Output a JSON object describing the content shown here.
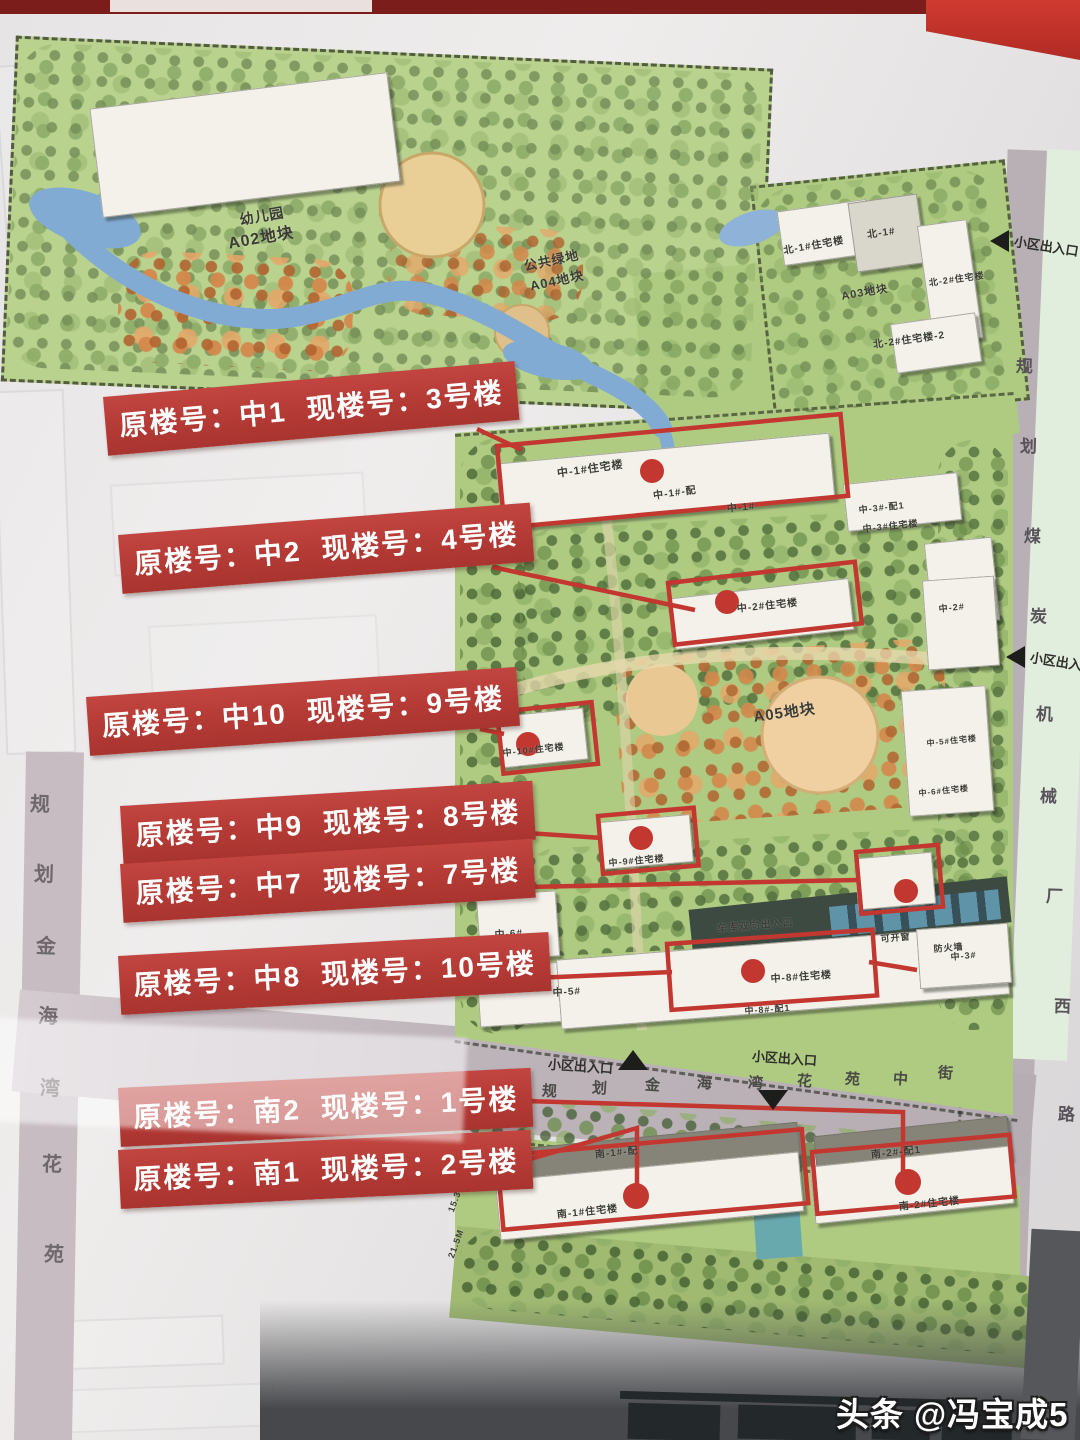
{
  "banners": {
    "label_old": "原楼号：",
    "label_new": "现楼号：",
    "items": [
      {
        "old": "中1",
        "new": "3号楼",
        "x": 103,
        "y": 397,
        "rot": -5.0
      },
      {
        "old": "中2",
        "new": "4号楼",
        "x": 118,
        "y": 535,
        "rot": -4.5
      },
      {
        "old": "中10",
        "new": "9号楼",
        "x": 86,
        "y": 697,
        "rot": -4.0
      },
      {
        "old": "中9",
        "new": "8号楼",
        "x": 120,
        "y": 806,
        "rot": -3.5
      },
      {
        "old": "中7",
        "new": "7号楼",
        "x": 120,
        "y": 864,
        "rot": -3.5
      },
      {
        "old": "中8",
        "new": "10号楼",
        "x": 118,
        "y": 956,
        "rot": -3.2
      },
      {
        "old": "南2",
        "new": "1号楼",
        "x": 118,
        "y": 1088,
        "rot": -2.8
      },
      {
        "old": "南1",
        "new": "2号楼",
        "x": 118,
        "y": 1150,
        "rot": -2.8
      }
    ]
  },
  "roads": {
    "west": {
      "name": "规划金海湾花苑",
      "chars": [
        {
          "c": "规",
          "x": 30,
          "y": 788
        },
        {
          "c": "划",
          "x": 34,
          "y": 858
        },
        {
          "c": "金",
          "x": 36,
          "y": 930
        },
        {
          "c": "海",
          "x": 38,
          "y": 1000
        },
        {
          "c": "湾",
          "x": 40,
          "y": 1072
        },
        {
          "c": "花",
          "x": 42,
          "y": 1148
        },
        {
          "c": "苑",
          "x": 44,
          "y": 1238
        }
      ]
    },
    "east": {
      "name": "规划煤炭机械厂西路",
      "chars": [
        {
          "c": "规",
          "x": 1016,
          "y": 352
        },
        {
          "c": "划",
          "x": 1020,
          "y": 432
        },
        {
          "c": "煤",
          "x": 1024,
          "y": 522
        },
        {
          "c": "炭",
          "x": 1030,
          "y": 602
        },
        {
          "c": "机",
          "x": 1036,
          "y": 700
        },
        {
          "c": "械",
          "x": 1040,
          "y": 782
        },
        {
          "c": "厂",
          "x": 1046,
          "y": 882
        },
        {
          "c": "西",
          "x": 1054,
          "y": 992
        },
        {
          "c": "路",
          "x": 1058,
          "y": 1100
        }
      ]
    },
    "middle": {
      "name": "规划金海湾花苑中街",
      "chars": [
        {
          "c": "规",
          "x": 542,
          "y": 1080
        },
        {
          "c": "划",
          "x": 592,
          "y": 1077
        },
        {
          "c": "金",
          "x": 645,
          "y": 1074
        },
        {
          "c": "海",
          "x": 697,
          "y": 1072
        },
        {
          "c": "湾",
          "x": 748,
          "y": 1072
        },
        {
          "c": "花",
          "x": 797,
          "y": 1070
        },
        {
          "c": "苑",
          "x": 845,
          "y": 1068
        },
        {
          "c": "中",
          "x": 893,
          "y": 1068
        },
        {
          "c": "街",
          "x": 938,
          "y": 1062
        }
      ]
    }
  },
  "entrances": [
    {
      "text": "小区出入口",
      "x": 1014,
      "y": 236,
      "rot": 9,
      "arrow": "left",
      "ax": 990,
      "ay": 230
    },
    {
      "text": "小区出入口",
      "x": 1030,
      "y": 652,
      "rot": 9,
      "arrow": "left",
      "ax": 1006,
      "ay": 646
    },
    {
      "text": "小区出入口",
      "x": 548,
      "y": 1056,
      "rot": 4,
      "arrow": "up",
      "ax": 618,
      "ay": 1050
    },
    {
      "text": "小区出入口",
      "x": 752,
      "y": 1048,
      "rot": 4,
      "arrow": "down",
      "ax": 758,
      "ay": 1090
    }
  ],
  "map_labels": [
    {
      "t": "幼儿园",
      "x": 238,
      "y": 210,
      "s": 14,
      "r": -10
    },
    {
      "t": "A02地块",
      "x": 226,
      "y": 230,
      "s": 16,
      "r": -10
    },
    {
      "t": "公共绿地",
      "x": 522,
      "y": 256,
      "s": 13,
      "r": -12
    },
    {
      "t": "A04地块",
      "x": 528,
      "y": 276,
      "s": 13,
      "r": -12
    },
    {
      "t": "北-1#住宅楼",
      "x": 782,
      "y": 242,
      "s": 10,
      "r": -10
    },
    {
      "t": "北-1#",
      "x": 866,
      "y": 226,
      "s": 10,
      "r": -8
    },
    {
      "t": "A03地块",
      "x": 840,
      "y": 288,
      "s": 11,
      "r": -10
    },
    {
      "t": "北-2#住宅楼",
      "x": 928,
      "y": 276,
      "s": 9,
      "r": -8
    },
    {
      "t": "北-2#住宅楼-2",
      "x": 872,
      "y": 336,
      "s": 10,
      "r": -8
    },
    {
      "t": "中-1#住宅楼",
      "x": 556,
      "y": 465,
      "s": 11,
      "r": -8
    },
    {
      "t": "中-1#-配",
      "x": 652,
      "y": 487,
      "s": 10,
      "r": -8
    },
    {
      "t": "中-1#",
      "x": 726,
      "y": 500,
      "s": 10,
      "r": -6
    },
    {
      "t": "中-3#-配1",
      "x": 858,
      "y": 503,
      "s": 9,
      "r": -6
    },
    {
      "t": "中-3#住宅楼",
      "x": 862,
      "y": 522,
      "s": 9,
      "r": -6
    },
    {
      "t": "中-2#住宅楼",
      "x": 736,
      "y": 600,
      "s": 10,
      "r": -6
    },
    {
      "t": "中-2#",
      "x": 938,
      "y": 602,
      "s": 9,
      "r": -6
    },
    {
      "t": "A05地块",
      "x": 752,
      "y": 706,
      "s": 15,
      "r": -8
    },
    {
      "t": "中-10#住宅楼",
      "x": 502,
      "y": 746,
      "s": 9,
      "r": -6
    },
    {
      "t": "中-5#住宅楼",
      "x": 926,
      "y": 738,
      "s": 8,
      "r": -6
    },
    {
      "t": "中-6#住宅楼",
      "x": 918,
      "y": 788,
      "s": 8,
      "r": -6
    },
    {
      "t": "中-9#住宅楼",
      "x": 608,
      "y": 856,
      "s": 9,
      "r": -5
    },
    {
      "t": "中-6#",
      "x": 494,
      "y": 926,
      "s": 10,
      "r": -4
    },
    {
      "t": "中-5#",
      "x": 552,
      "y": 984,
      "s": 10,
      "r": -4
    },
    {
      "t": "车库双向出入口",
      "x": 716,
      "y": 920,
      "s": 10,
      "r": -5
    },
    {
      "t": "可开窗",
      "x": 880,
      "y": 932,
      "s": 9,
      "r": -5
    },
    {
      "t": "防火墙",
      "x": 933,
      "y": 942,
      "s": 9,
      "r": -5
    },
    {
      "t": "中-3#",
      "x": 950,
      "y": 950,
      "s": 9,
      "r": -5
    },
    {
      "t": "中-8#住宅楼",
      "x": 770,
      "y": 970,
      "s": 10,
      "r": -4
    },
    {
      "t": "中-8#-配1",
      "x": 744,
      "y": 1004,
      "s": 9,
      "r": -4
    },
    {
      "t": "南-1#-配",
      "x": 594,
      "y": 1146,
      "s": 10,
      "r": -6
    },
    {
      "t": "南-1#住宅楼",
      "x": 556,
      "y": 1206,
      "s": 10,
      "r": -6
    },
    {
      "t": "南-2#-配1",
      "x": 870,
      "y": 1146,
      "s": 10,
      "r": -6
    },
    {
      "t": "南-2#住宅楼",
      "x": 898,
      "y": 1198,
      "s": 10,
      "r": -6
    },
    {
      "t": "15.30M",
      "x": 446,
      "y": 1210,
      "s": 9,
      "r": -70
    },
    {
      "t": "21.5M",
      "x": 446,
      "y": 1256,
      "s": 9,
      "r": -70
    }
  ],
  "watermark": {
    "brand": "头条",
    "handle": "@冯宝成5"
  },
  "colors": {
    "banner_red": "#b43a35",
    "annotation_red": "#c2372f",
    "map_green": "#aecb81",
    "water_blue": "#82abd4",
    "road_gray": "#b9b0b6",
    "frame_red": "#7b1d1a"
  }
}
